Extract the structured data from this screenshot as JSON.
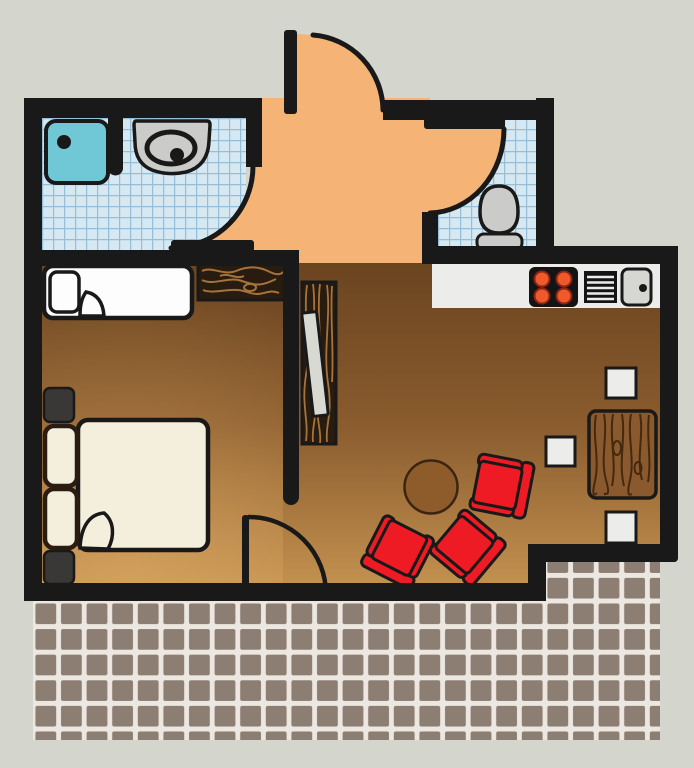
{
  "scene": {
    "description": "apartment floor plan, top-down vector illustration",
    "canvas_width": 694,
    "canvas_height": 768
  },
  "colors": {
    "background": "#d4d6ce",
    "wall": "#191919",
    "door_swing": "#f5b376",
    "bath_tile_bg": "#d6e9f2",
    "bath_tile_line": "#96bed6",
    "shower": "#70c8d6",
    "fixture": "#cbcbc9",
    "floor_dark": "#68421f",
    "floor_mid": "#8a5c2e",
    "floor_light": "#c89552",
    "floor_glow": "#e5b169",
    "counter": "#ececea",
    "stove": "#141414",
    "burner": "#f05a2b",
    "burner_ring": "#8d2413",
    "sink_steel": "#d6d6d2",
    "chair": "#ee1b24",
    "table_wood": "#8a5a2e",
    "grain_dark": "#44290f",
    "grain_light": "#a6733b",
    "dark_wood": "#281b0f",
    "table_round": "#8d5c2a",
    "table_round_outline": "#3b2511",
    "terrace_tile": "#8d7e73",
    "terrace_grout": "#ece8e1",
    "bed_white": "#fdfdfd",
    "bed_cream": "#f3efdc",
    "pillow_outline": "#2a1c10",
    "nightstand": "#3a3836",
    "slab": "#d9d9d4"
  },
  "rooms": [
    {
      "id": "bathroom",
      "floor": "blue-tile",
      "fixtures": [
        "shower",
        "sink"
      ]
    },
    {
      "id": "wc",
      "floor": "blue-tile",
      "fixtures": [
        "toilet"
      ]
    },
    {
      "id": "entry-hall",
      "floor": "orange"
    },
    {
      "id": "bedroom",
      "floor": "wood-gradient",
      "furniture": [
        "single-bed",
        "wardrobe",
        "double-bed",
        "nightstand",
        "nightstand"
      ]
    },
    {
      "id": "living-room",
      "floor": "wood-gradient",
      "furniture": [
        "shelf",
        "leaning-board",
        "coffee-table",
        "armchair",
        "armchair",
        "armchair",
        "dining-table",
        "stool",
        "stool",
        "stool"
      ]
    },
    {
      "id": "kitchen",
      "furniture": [
        "counter",
        "stove",
        "dish-drainer",
        "sink"
      ]
    },
    {
      "id": "terrace",
      "floor": "brown-tile"
    }
  ],
  "counts": {
    "armchairs": 3,
    "stools": 3,
    "burners": 4,
    "pillows_double_bed": 2,
    "nightstands": 2
  },
  "doors": [
    {
      "id": "entrance-door",
      "state": "open",
      "swing": "outward-top"
    },
    {
      "id": "bathroom-door",
      "state": "open",
      "swing": "into-bathroom"
    },
    {
      "id": "wc-door",
      "state": "open",
      "swing": "into-wc"
    },
    {
      "id": "terrace-door",
      "state": "open",
      "swing": "into-living-room"
    }
  ]
}
